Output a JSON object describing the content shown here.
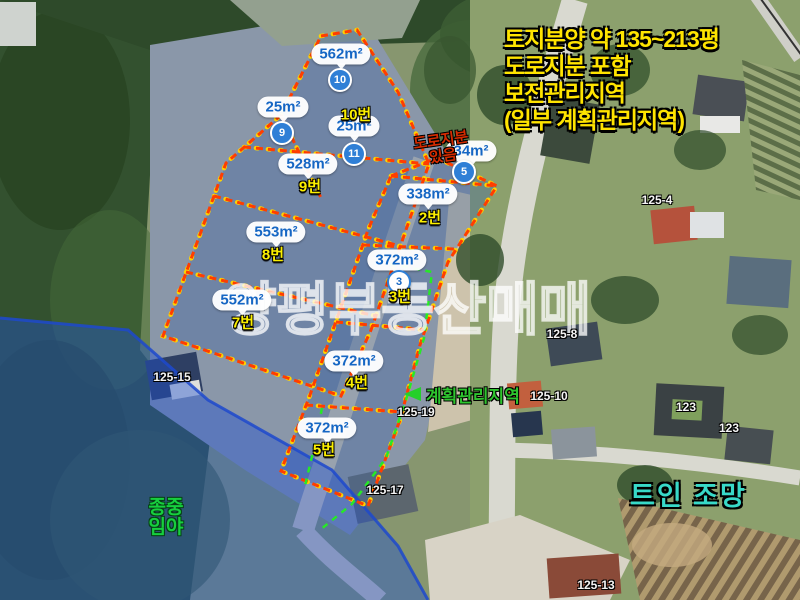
{
  "headline": {
    "line1": "토지분양 약 135~213평",
    "line2": "도로지분 포함",
    "line3": "보전관리지역",
    "line4": "(일부 계획관리지역)"
  },
  "watermark": {
    "text": "양평부동산매매"
  },
  "annotations": {
    "road_share_note": {
      "line1": "도로지분",
      "line2": "있음"
    },
    "plan_zone_label": {
      "text": "계획관리지역"
    },
    "clan_forest_label": {
      "line1": "종중",
      "line2": "임야"
    },
    "open_view_label": {
      "text": "트인 조망"
    }
  },
  "area_bubbles": [
    {
      "area": "562m²"
    },
    {
      "area": "25m²"
    },
    {
      "area": "25m²"
    },
    {
      "area": "528m²"
    },
    {
      "area": "553m²"
    },
    {
      "area": "552m²"
    },
    {
      "area": "34m²"
    },
    {
      "area": "338m²"
    },
    {
      "area": "372m²"
    },
    {
      "area": "372m²"
    },
    {
      "area": "372m²"
    }
  ],
  "circle_markers": [
    {
      "num": "10"
    },
    {
      "num": "9"
    },
    {
      "num": "11"
    },
    {
      "num": "5"
    },
    {
      "num": "3"
    }
  ],
  "parcel_labels": [
    {
      "text": "10번"
    },
    {
      "text": "9번"
    },
    {
      "text": "8번"
    },
    {
      "text": "7번"
    },
    {
      "text": "2번"
    },
    {
      "text": "3번"
    },
    {
      "text": "4번"
    },
    {
      "text": "5번"
    }
  ],
  "lot_numbers": [
    {
      "text": "125-4"
    },
    {
      "text": "125-8"
    },
    {
      "text": "125-10"
    },
    {
      "text": "123"
    },
    {
      "text": "123"
    },
    {
      "text": "125-19"
    },
    {
      "text": "125-15"
    },
    {
      "text": "125-17"
    },
    {
      "text": "125-13"
    }
  ],
  "colors": {
    "headline_yellow": "#ffe400",
    "bubble_text_blue": "#1566c4",
    "parcel_label_yellow": "#fbef00",
    "circle_blue": "#2f7fd6",
    "dash_red": "#ff3d00",
    "dash_yellow": "#ffd400",
    "plan_zone_green": "#2ec52e",
    "forest_label_green": "#17cf3e",
    "open_view_cyan": "#38d9c8",
    "blue_overlay_edge": "#1d49cc",
    "road_share_red": "#d42b00"
  }
}
